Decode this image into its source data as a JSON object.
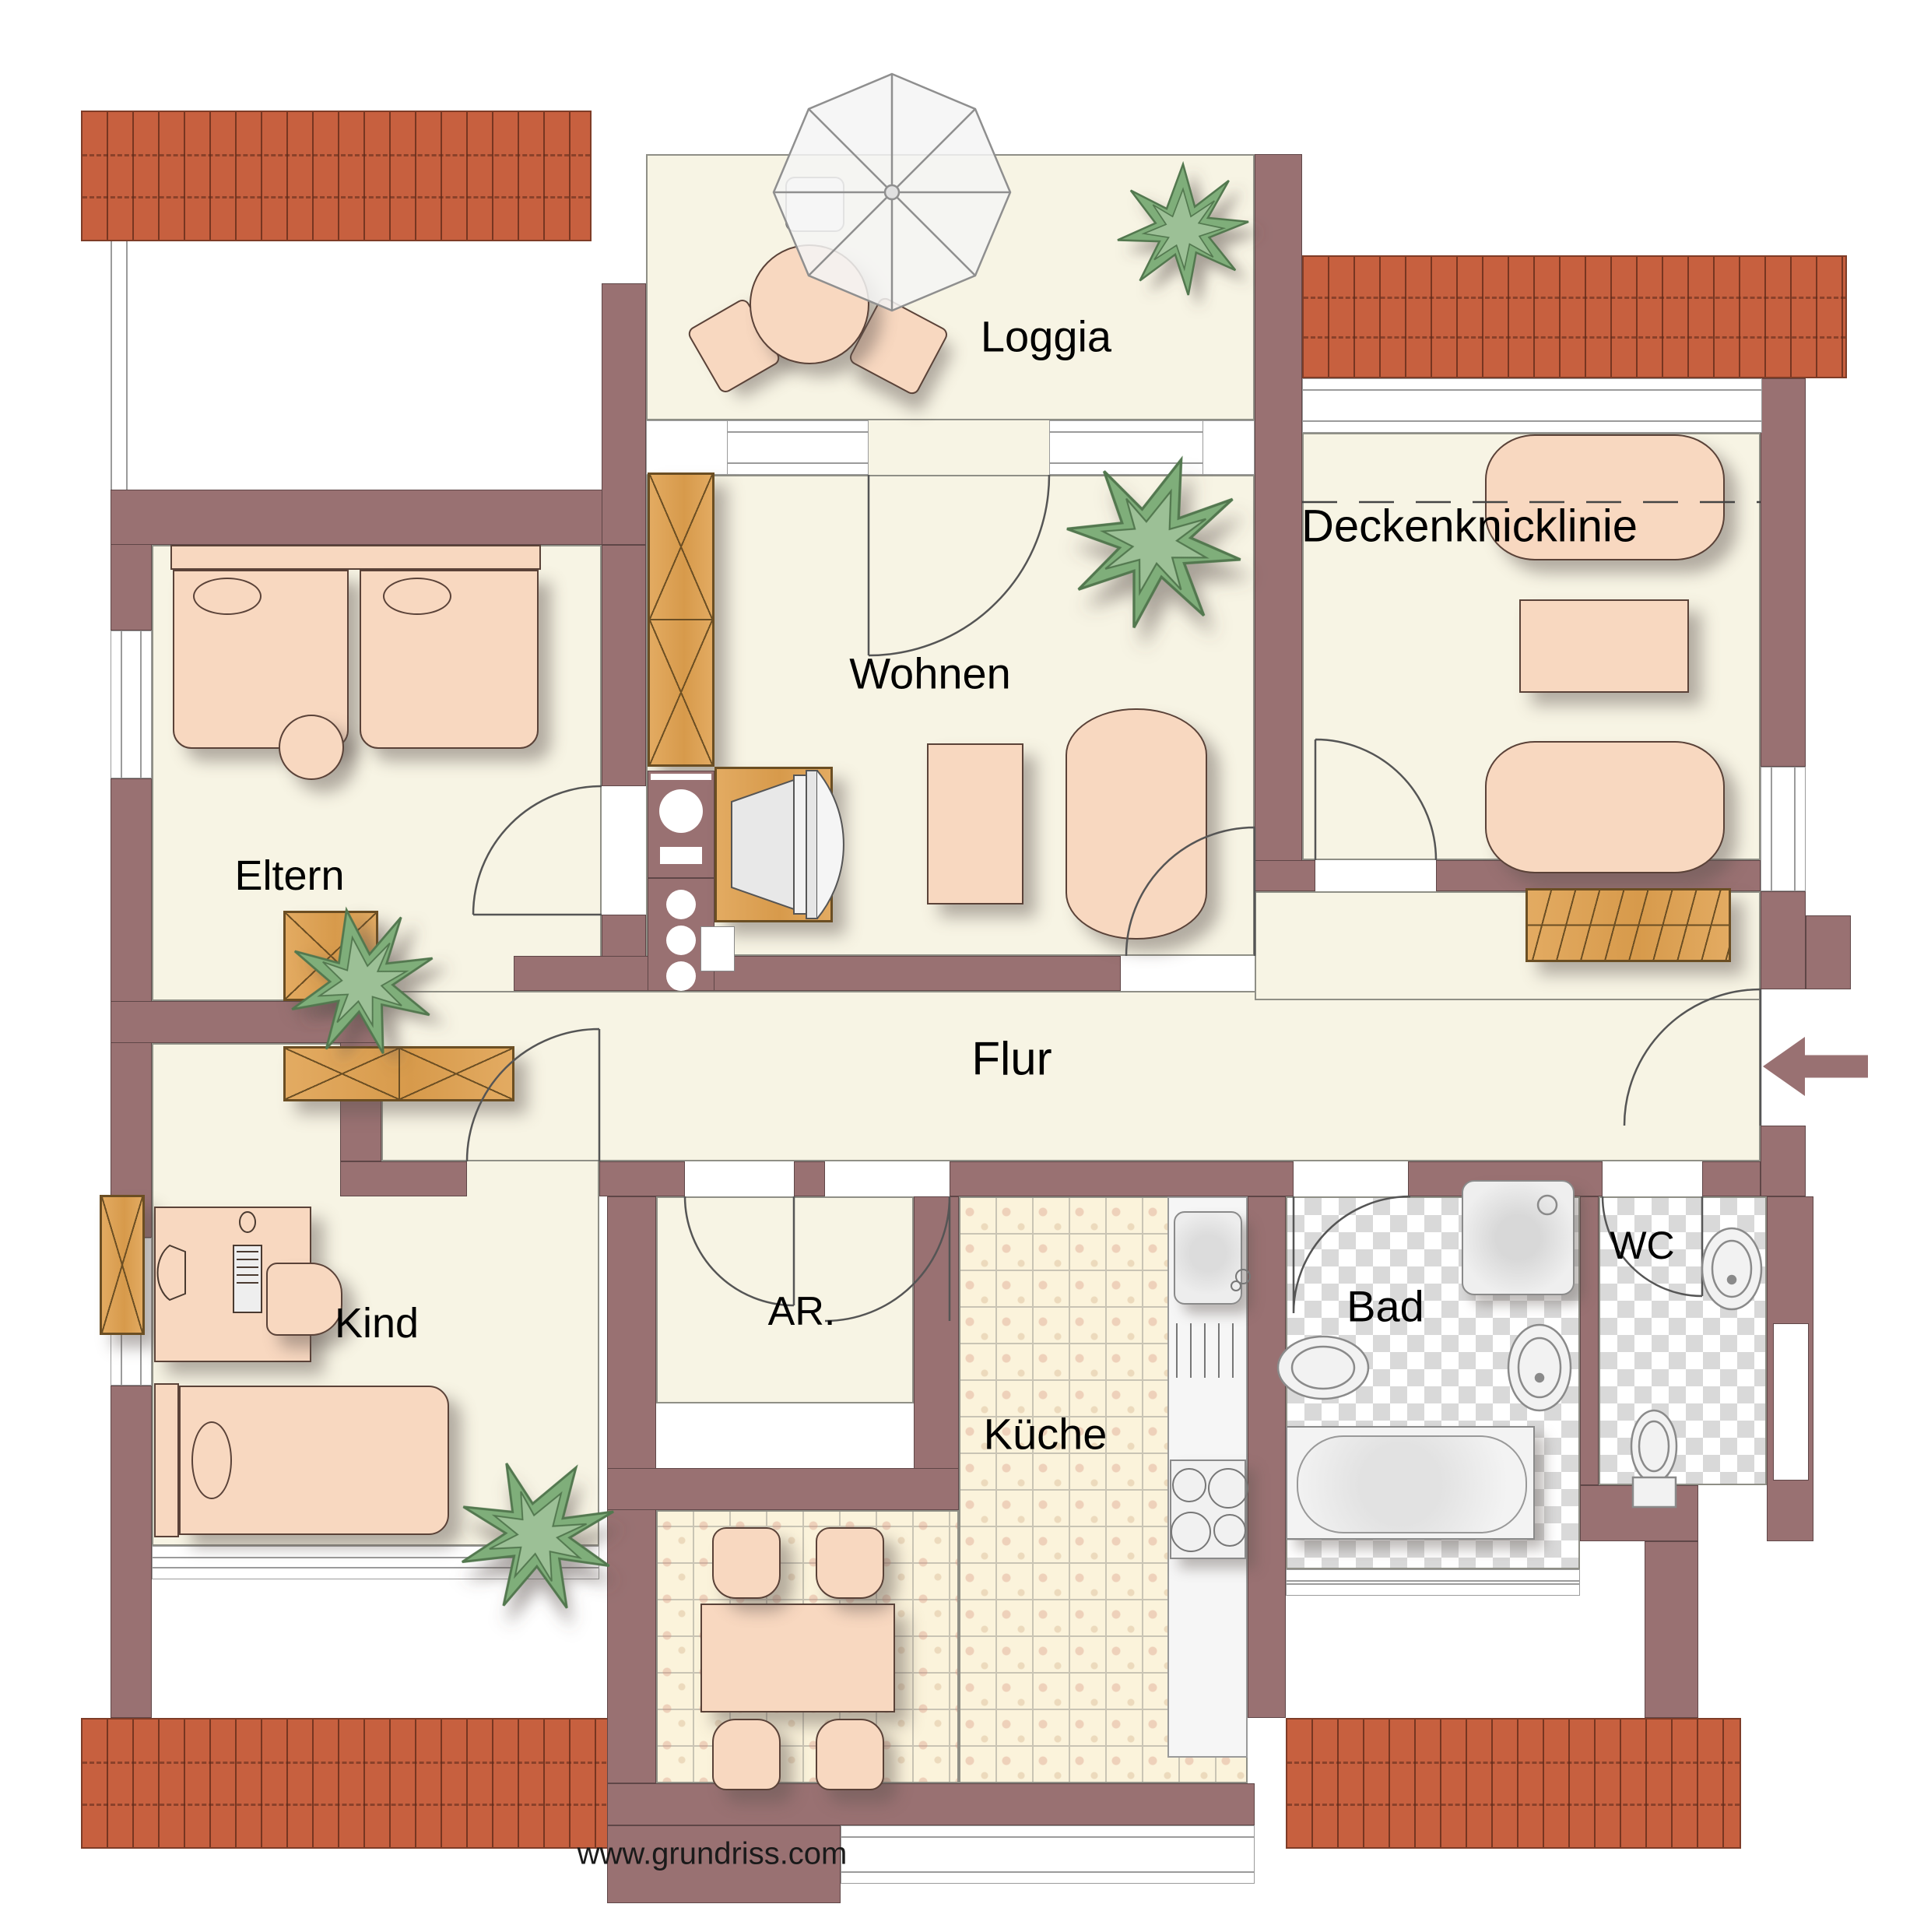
{
  "rooms": {
    "loggia": {
      "label": "Loggia"
    },
    "wohnen": {
      "label": "Wohnen"
    },
    "eltern": {
      "label": "Eltern"
    },
    "kind": {
      "label": "Kind"
    },
    "flur": {
      "label": "Flur"
    },
    "ar": {
      "label": "AR."
    },
    "kueche": {
      "label": "Küche"
    },
    "bad": {
      "label": "Bad"
    },
    "wc": {
      "label": "WC"
    }
  },
  "annotations": {
    "deckenknicklinie": {
      "label": "Deckenknicklinie"
    },
    "watermark": {
      "label": "www.grundriss.com"
    },
    "entrance_arrow": {
      "icon": "arrow-left",
      "meaning": "entrance"
    }
  },
  "colors": {
    "wall": "#997172",
    "wallline": "#5f4647",
    "floor": "#f7f4e4",
    "floorline": "#8f8f86",
    "roof": "#c7603f",
    "roofline": "#7e3c27",
    "wood": "#dfa55b",
    "woodline": "#6b4e23",
    "furn": "#f8d8c0",
    "furnline": "#5a4238",
    "fixture": "#efefef",
    "fixline": "#8a8a8a",
    "grout": "#c9c4b4",
    "checker": "#d9d9d9",
    "ink": "#000000"
  }
}
